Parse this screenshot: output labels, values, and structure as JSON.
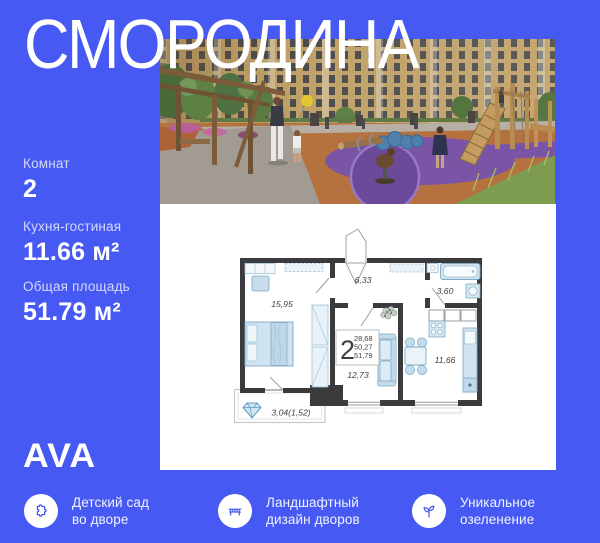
{
  "header": {
    "title": "СМОРОДИНА"
  },
  "specs": [
    {
      "label": "Комнат",
      "value": "2"
    },
    {
      "label": "Кухня-гостиная",
      "value": "11.66 м²"
    },
    {
      "label": "Общая площадь",
      "value": "51.79 м²"
    }
  ],
  "developer": {
    "logo": "AVA"
  },
  "floorplan": {
    "summary": {
      "rooms": "2",
      "living_area": "28,68",
      "area_without_balcony": "50,27",
      "total_area": "51,79"
    },
    "rooms": {
      "bedroom": "15,95",
      "hallway": "6,33",
      "bathroom": "3,60",
      "living": "12,73",
      "kitchen": "11,66",
      "balcony": "3,04(1,52)"
    }
  },
  "features": [
    {
      "icon": "puzzle-icon",
      "lines": [
        "Детский сад",
        "во дворе"
      ]
    },
    {
      "icon": "bench-icon",
      "lines": [
        "Ландшафтный",
        "дизайн дворов"
      ]
    },
    {
      "icon": "sprout-icon",
      "lines": [
        "Уникальное",
        "озеленение"
      ]
    }
  ],
  "colors": {
    "background": "#4659f3",
    "text": "#ffffff",
    "plan_walls": "#3b3b3d",
    "icon_blue": "#4557ef"
  }
}
